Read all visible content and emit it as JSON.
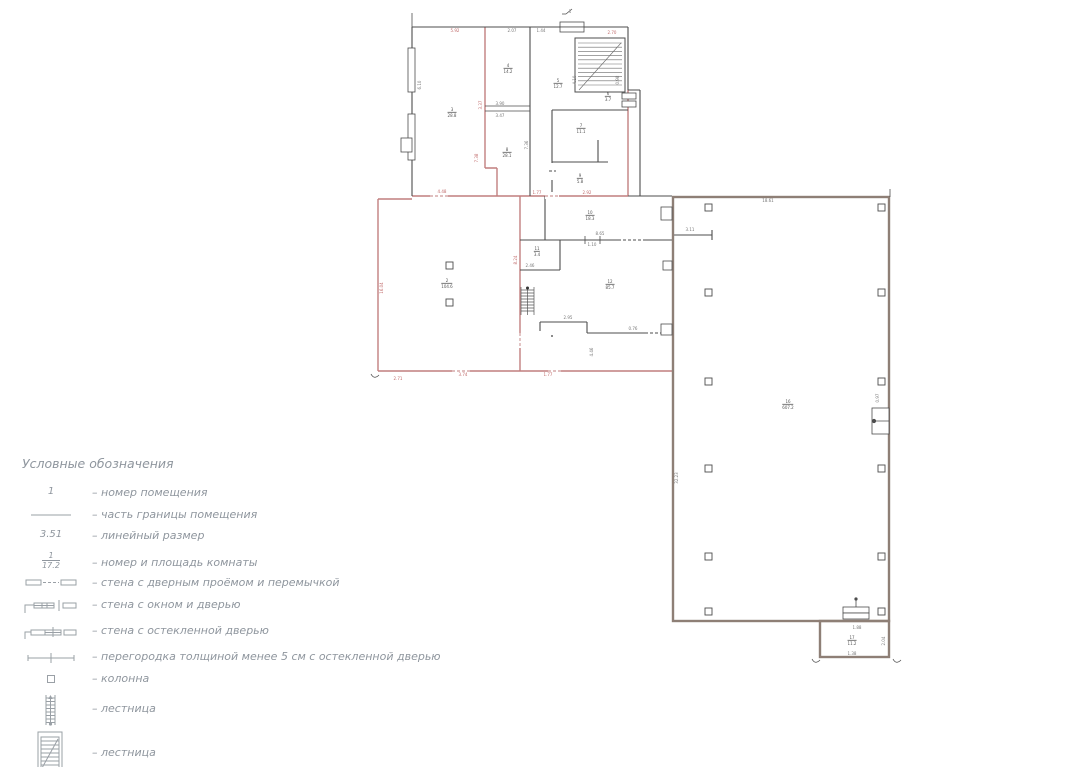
{
  "legend": {
    "title": "Условные обозначения",
    "items": [
      {
        "symbol": "room-number-example",
        "symbol_text": "1",
        "label": "– номер помещения"
      },
      {
        "symbol": "boundary-line",
        "label": "– часть границы помещения"
      },
      {
        "symbol": "linear-dimension-example",
        "symbol_text": "3.51",
        "label": "– линейный размер"
      },
      {
        "symbol": "room-number-area-example",
        "symbol_num": "1",
        "symbol_den": "17.2",
        "label": "– номер и площадь комнаты"
      },
      {
        "symbol": "wall-with-door-opening-and-lintel",
        "label": "– стена с дверным проёмом и перемычкой"
      },
      {
        "symbol": "wall-with-window-and-door",
        "label": "– стена с окном и дверью"
      },
      {
        "symbol": "wall-with-glazed-door",
        "label": "– стена с остекленной дверью"
      },
      {
        "symbol": "thin-partition-with-glazed-door",
        "label": "– перегородка толщиной менее 5 см с остекленной дверью"
      },
      {
        "symbol": "column",
        "label": "– колонна"
      },
      {
        "symbol": "stair-straight-run",
        "label": "– лестница"
      },
      {
        "symbol": "stairwell",
        "label": "– лестница"
      }
    ]
  },
  "plan": {
    "dims": [
      {
        "x": 455,
        "y": 31,
        "t": "5.92",
        "c": "r"
      },
      {
        "x": 512,
        "y": 31,
        "t": "2.07",
        "c": "d"
      },
      {
        "x": 541,
        "y": 31,
        "t": "1.44",
        "c": "d"
      },
      {
        "x": 612,
        "y": 33,
        "t": "2.70",
        "c": "r"
      },
      {
        "x": 570,
        "y": 12,
        "t": "1",
        "c": "d"
      },
      {
        "x": 420,
        "y": 85,
        "t": "6.10",
        "c": "d",
        "rot": 1
      },
      {
        "x": 481,
        "y": 105,
        "t": "3.37",
        "c": "r",
        "rot": 1
      },
      {
        "x": 500,
        "y": 104,
        "t": "3.90",
        "c": "d"
      },
      {
        "x": 500,
        "y": 116,
        "t": "3.47",
        "c": "d"
      },
      {
        "x": 527,
        "y": 145,
        "t": "7.36",
        "c": "d",
        "rot": 1
      },
      {
        "x": 575,
        "y": 80,
        "t": "4.10",
        "c": "d",
        "rot": 1
      },
      {
        "x": 618,
        "y": 80,
        "t": "0.98",
        "c": "d",
        "rot": 1
      },
      {
        "x": 442,
        "y": 192,
        "t": "4.48",
        "c": "r"
      },
      {
        "x": 477,
        "y": 158,
        "t": "7.38",
        "c": "r",
        "rot": 1
      },
      {
        "x": 537,
        "y": 193,
        "t": "1.77",
        "c": "r"
      },
      {
        "x": 587,
        "y": 193,
        "t": "2.92",
        "c": "r"
      },
      {
        "x": 382,
        "y": 288,
        "t": "16.04",
        "c": "r",
        "rot": 1
      },
      {
        "x": 600,
        "y": 234,
        "t": "8.65",
        "c": "d"
      },
      {
        "x": 592,
        "y": 245,
        "t": "1.10",
        "c": "d"
      },
      {
        "x": 690,
        "y": 230,
        "t": "3.11",
        "c": "d"
      },
      {
        "x": 768,
        "y": 201,
        "t": "18.61",
        "c": "d"
      },
      {
        "x": 878,
        "y": 398,
        "t": "0.97",
        "c": "d",
        "rot": 1
      },
      {
        "x": 677,
        "y": 478,
        "t": "32.23",
        "c": "d",
        "rot": 1
      },
      {
        "x": 516,
        "y": 260,
        "t": "8.24",
        "c": "r",
        "rot": 1
      },
      {
        "x": 530,
        "y": 266,
        "t": "2.46",
        "c": "d"
      },
      {
        "x": 568,
        "y": 318,
        "t": "2.95",
        "c": "d"
      },
      {
        "x": 633,
        "y": 329,
        "t": "0.76",
        "c": "d"
      },
      {
        "x": 592,
        "y": 352,
        "t": "4.46",
        "c": "d",
        "rot": 1
      },
      {
        "x": 463,
        "y": 375,
        "t": "3.74",
        "c": "r"
      },
      {
        "x": 548,
        "y": 375,
        "t": "1.77",
        "c": "r"
      },
      {
        "x": 398,
        "y": 379,
        "t": "2.71",
        "c": "r"
      },
      {
        "x": 857,
        "y": 628,
        "t": "1.88",
        "c": "d"
      },
      {
        "x": 852,
        "y": 654,
        "t": "1.38",
        "c": "d"
      },
      {
        "x": 884,
        "y": 641,
        "t": "2.04",
        "c": "d",
        "rot": 1
      }
    ],
    "rooms": [
      {
        "x": 452,
        "y": 113,
        "n": "3",
        "s": "28.8"
      },
      {
        "x": 508,
        "y": 69,
        "n": "4",
        "s": "14.2"
      },
      {
        "x": 558,
        "y": 84,
        "n": "5",
        "s": "12.7"
      },
      {
        "x": 608,
        "y": 97,
        "n": "6",
        "s": "3.7"
      },
      {
        "x": 581,
        "y": 129,
        "n": "7",
        "s": "11.1"
      },
      {
        "x": 507,
        "y": 153,
        "n": "8",
        "s": "28.1"
      },
      {
        "x": 580,
        "y": 179,
        "n": "9",
        "s": "5.8"
      },
      {
        "x": 590,
        "y": 216,
        "n": "10",
        "s": "18.3"
      },
      {
        "x": 537,
        "y": 252,
        "n": "11",
        "s": "3.4"
      },
      {
        "x": 447,
        "y": 284,
        "n": "2",
        "s": "104.6"
      },
      {
        "x": 610,
        "y": 285,
        "n": "12",
        "s": "85.7"
      },
      {
        "x": 788,
        "y": 405,
        "n": "16",
        "s": "607.2"
      },
      {
        "x": 852,
        "y": 641,
        "n": "17",
        "s": "11.2"
      }
    ]
  },
  "colors": {
    "wall_red": "#c17f7f",
    "wall_dark": "#4d4d4d",
    "wall_hall": "#8e7f76",
    "dim_red": "#c06a6a",
    "dim_dark": "#777777",
    "legend_text": "#8f969e"
  }
}
